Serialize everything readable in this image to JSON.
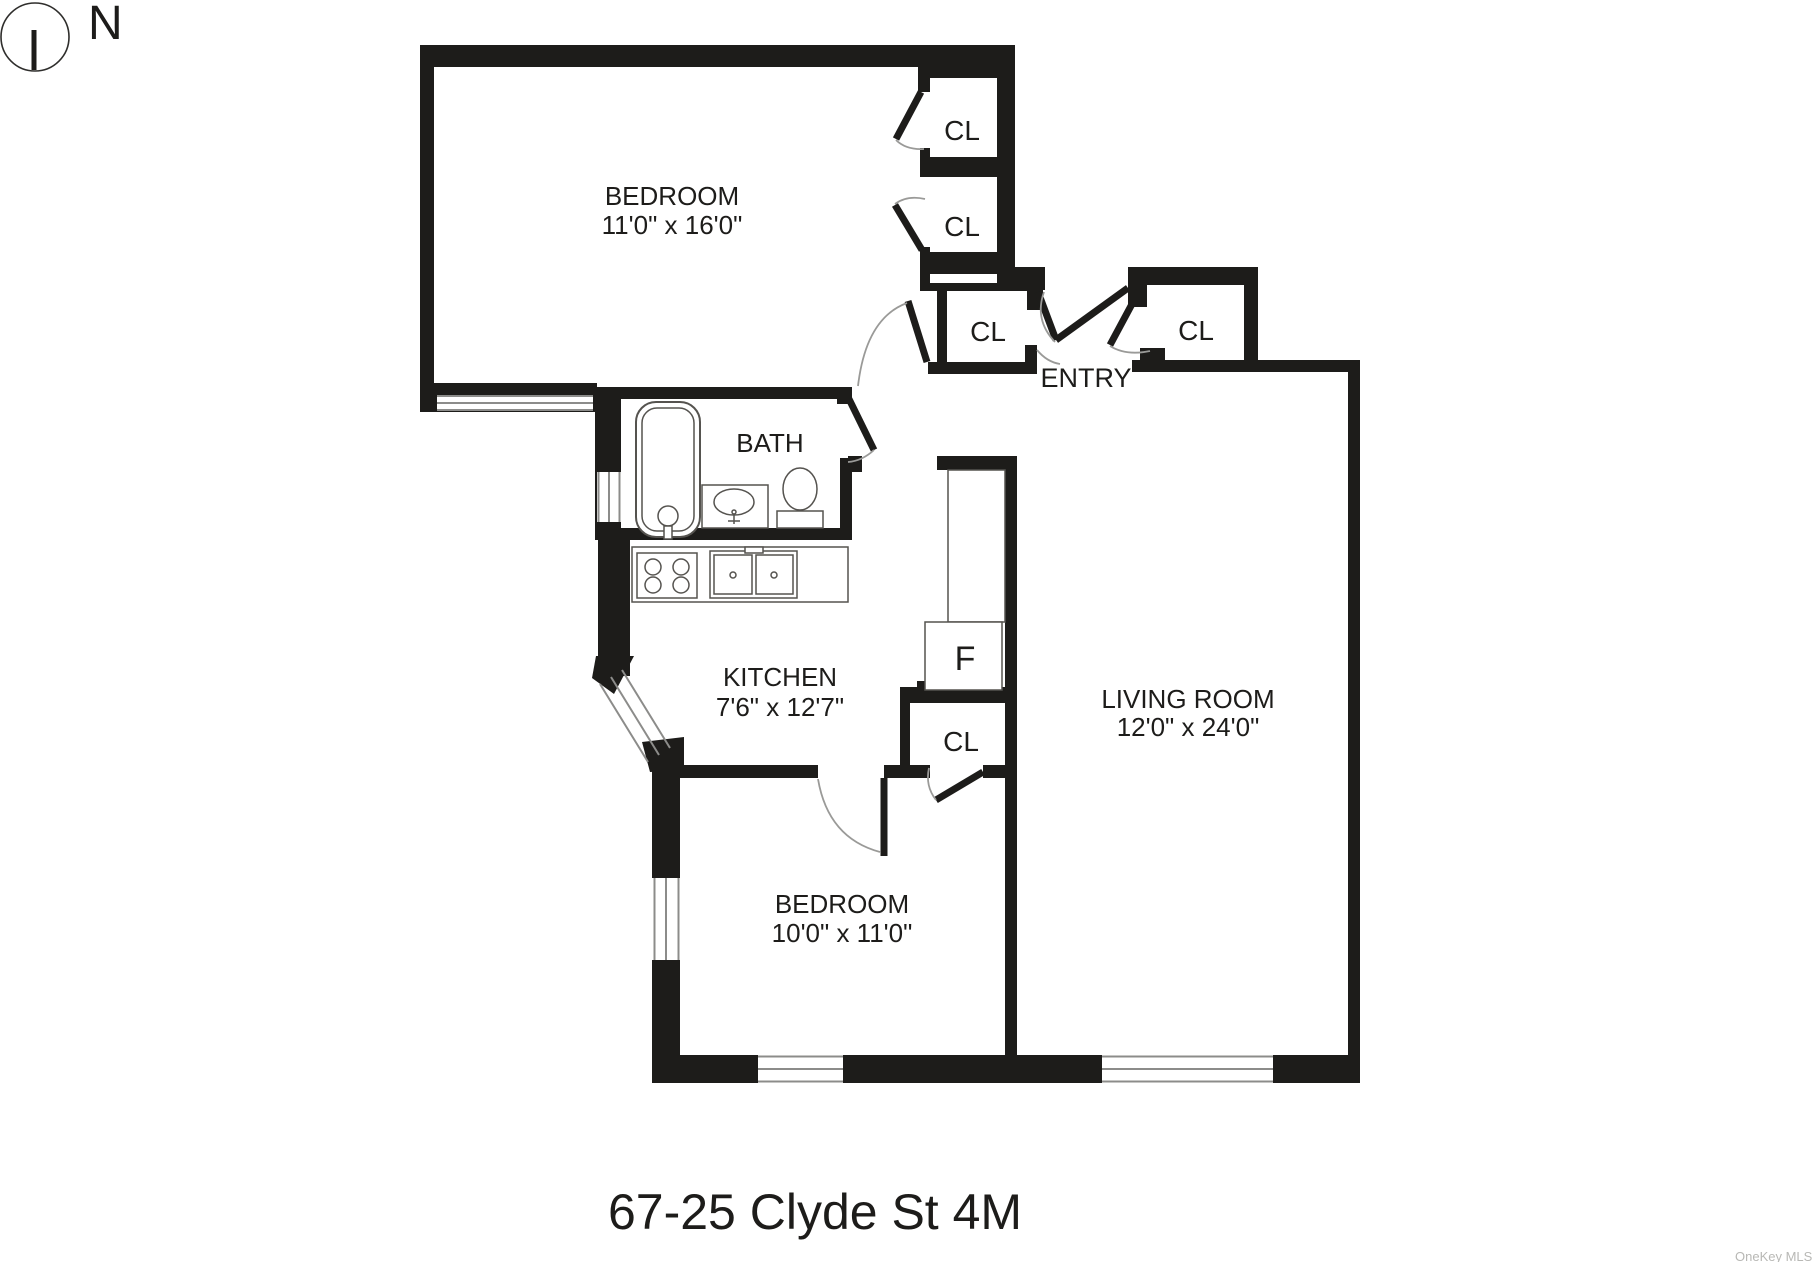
{
  "compass": {
    "north_label": "N"
  },
  "plan": {
    "rooms": {
      "bedroom_top": {
        "name": "BEDROOM",
        "dims": "11'0\" x 16'0\""
      },
      "bath": {
        "name": "BATH"
      },
      "kitchen": {
        "name": "KITCHEN",
        "dims": "7'6\" x 12'7\""
      },
      "bedroom_bottom": {
        "name": "BEDROOM",
        "dims": "10'0\" x 11'0\""
      },
      "living_room": {
        "name": "LIVING ROOM",
        "dims": "12'0\" x 24'0\""
      },
      "entry": {
        "name": "ENTRY"
      }
    },
    "closets": {
      "closet_top_1": "CL",
      "closet_top_2": "CL",
      "closet_entry_left": "CL",
      "closet_entry_right": "CL",
      "closet_bedroom_bottom": "CL"
    },
    "appliances": {
      "refrigerator": "F"
    }
  },
  "footer": {
    "title": "67-25 Clyde St 4M",
    "watermark": "OneKey MLS"
  },
  "colors": {
    "wall": "#1d1c1a",
    "fixture_line": "#55534f",
    "arc_line": "#9a9a98",
    "window_line": "#8c8c8a",
    "text": "#1d1c1a",
    "watermark": "#b8b8b5",
    "background": "#ffffff"
  }
}
